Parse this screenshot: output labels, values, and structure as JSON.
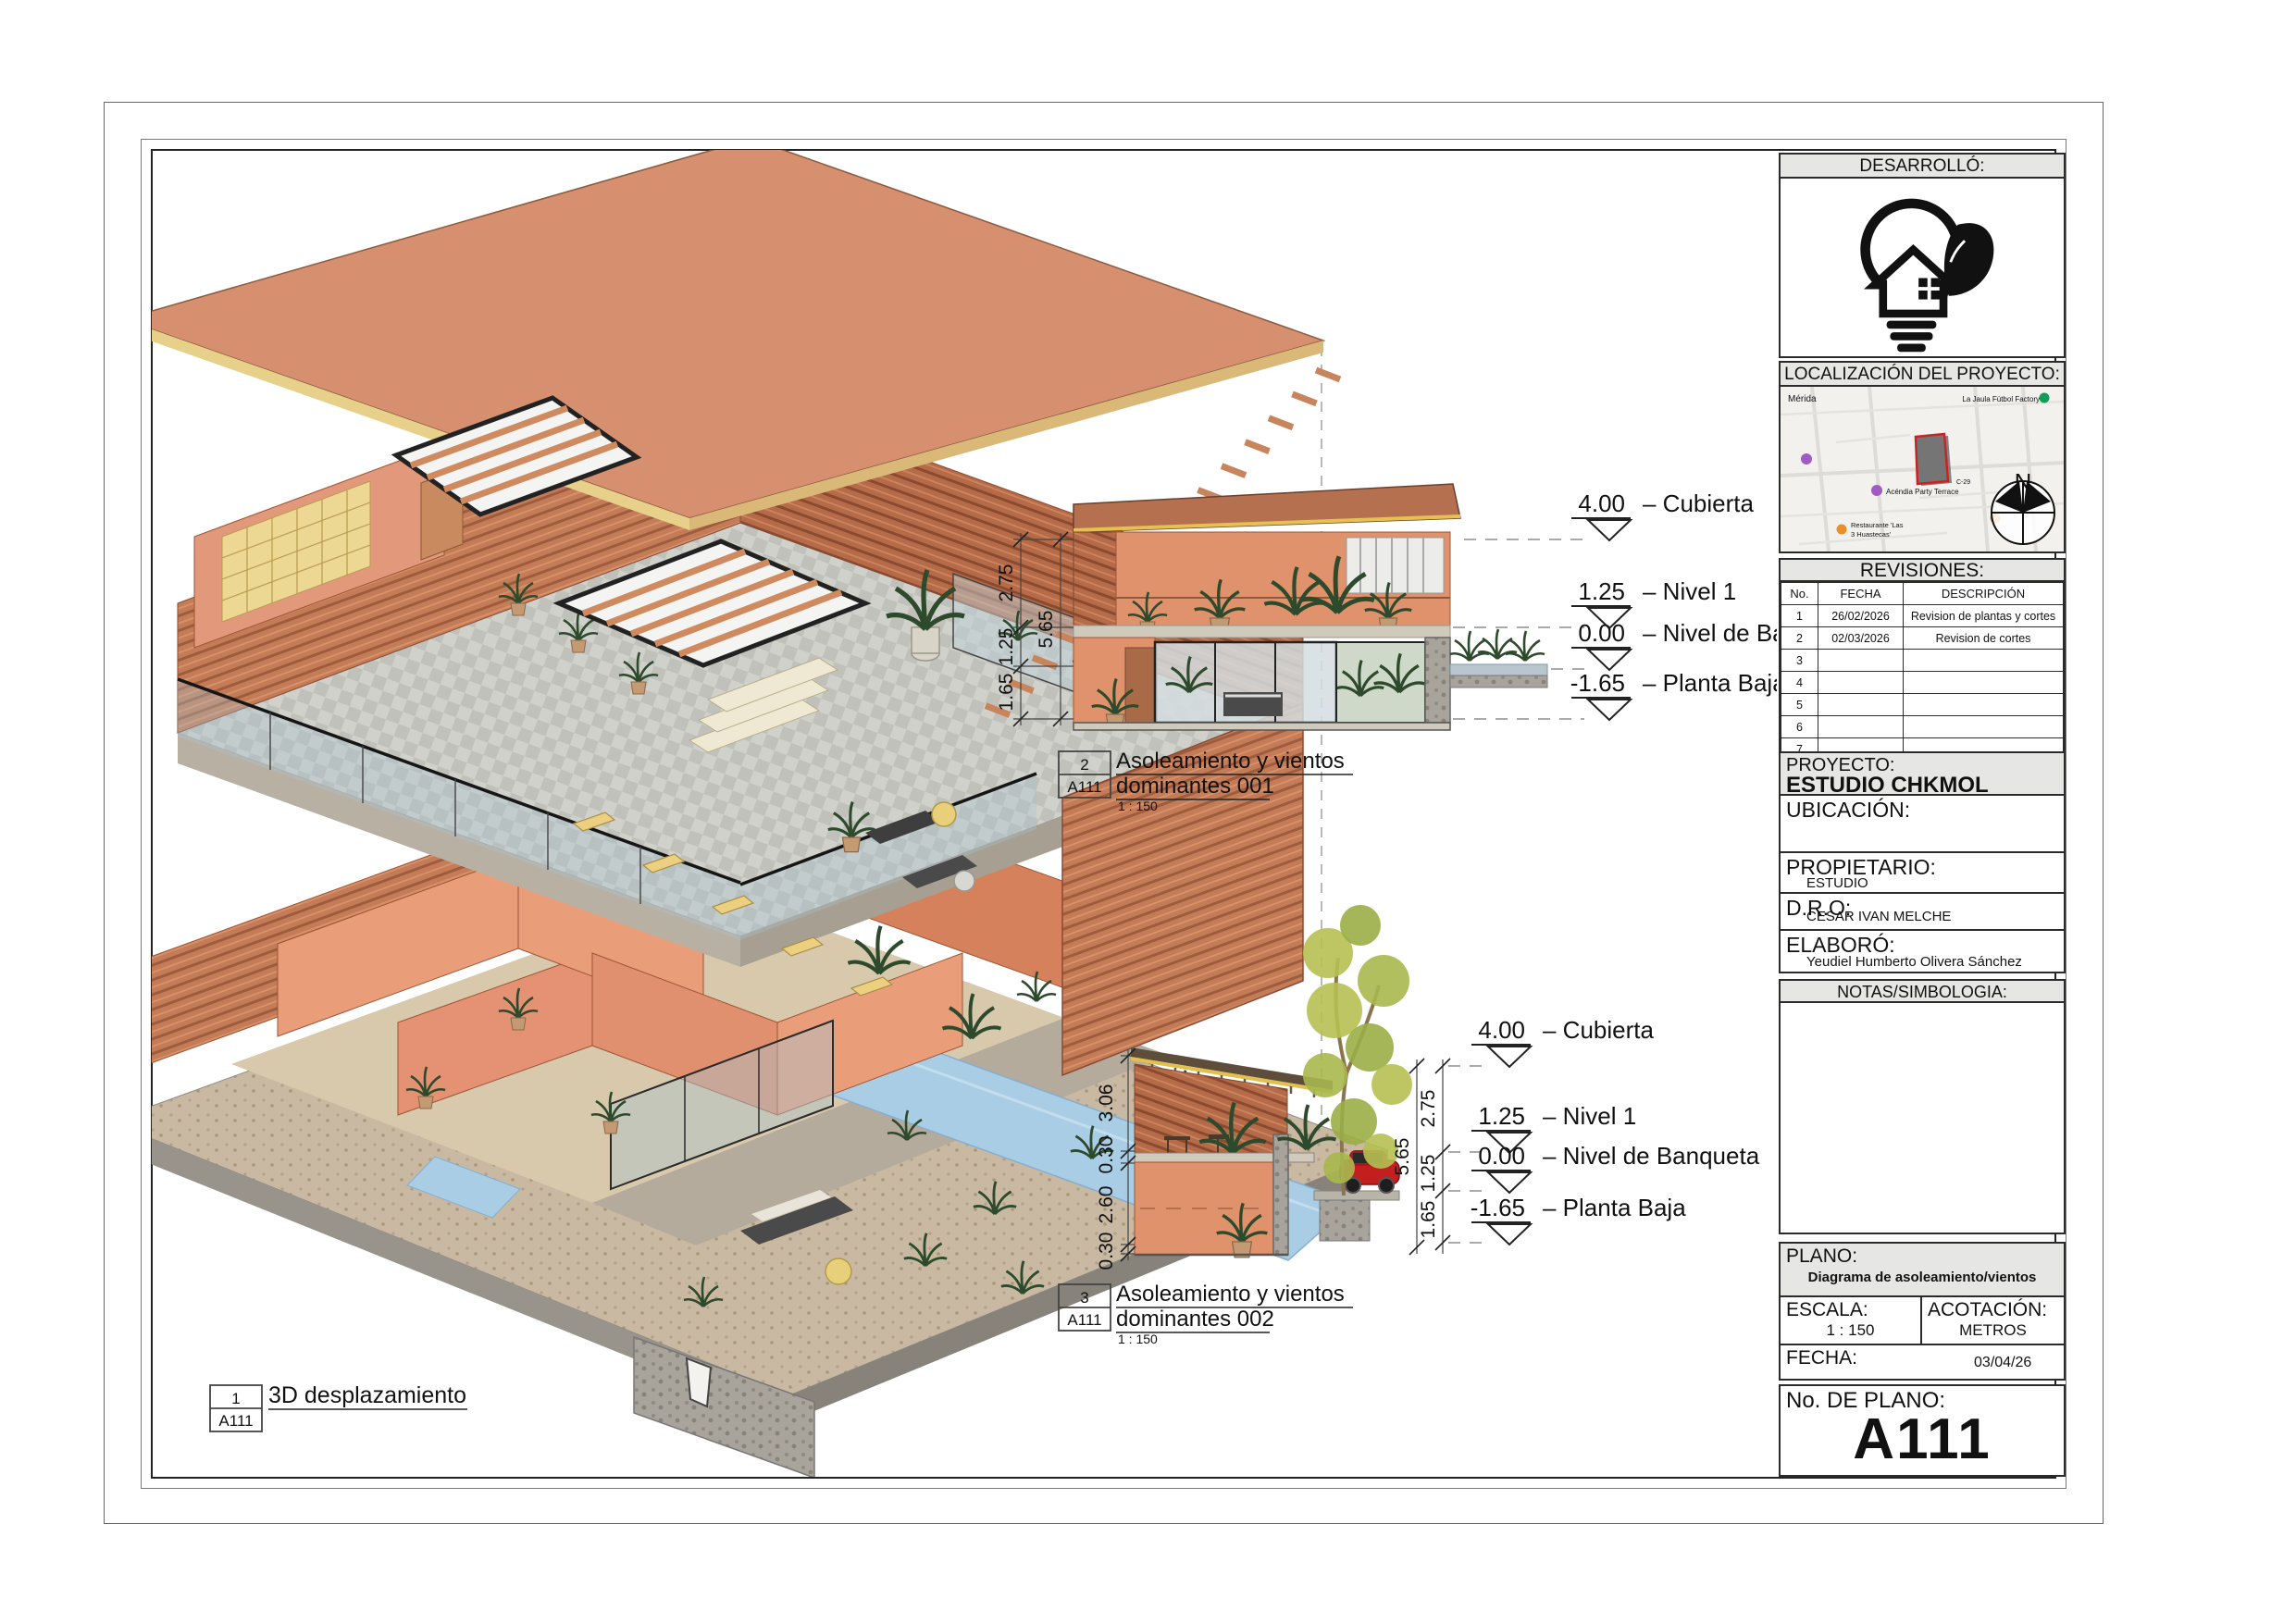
{
  "titleblock": {
    "desarrollo_label": "DESARROLLÓ:",
    "localizacion_label": "LOCALIZACIÓN DEL PROYECTO:",
    "revisiones": {
      "label": "REVISIONES:",
      "headers": [
        "No.",
        "FECHA",
        "DESCRIPCIÓN"
      ],
      "rows": [
        [
          "1",
          "26/02/2026",
          "Revision de plantas y cortes"
        ],
        [
          "2",
          "02/03/2026",
          "Revision de cortes"
        ],
        [
          "3",
          "",
          ""
        ],
        [
          "4",
          "",
          ""
        ],
        [
          "5",
          "",
          ""
        ],
        [
          "6",
          "",
          ""
        ],
        [
          "7",
          "",
          ""
        ]
      ]
    },
    "proyecto_label": "PROYECTO:",
    "proyecto_value": "ESTUDIO CHKMOL",
    "ubicacion_label": "UBICACIÓN:",
    "propietario_label": "PROPIETARIO:",
    "propietario_value": "ESTUDIO",
    "dro_label": "D.R.O:",
    "dro_value": "CESAR IVAN MELCHE",
    "elaboro_label": "ELABORÓ:",
    "elaboro_value": "Yeudiel Humberto Olivera Sánchez",
    "notas_label": "NOTAS/SIMBOLOGIA:",
    "plano_label": "PLANO:",
    "plano_value": "Diagrama de asoleamiento/vientos",
    "escala_label": "ESCALA:",
    "escala_value": "1 : 150",
    "acotacion_label": "ACOTACIÓN:",
    "acotacion_value": "METROS",
    "fecha_label": "FECHA:",
    "fecha_value": "03/04/26",
    "num_plano_label": "No. DE PLANO:",
    "num_plano_value": "A111"
  },
  "map": {
    "city": "Mérida",
    "poi1": "La Jaula Fútbol Factory",
    "poi2": "Acéndia Party Terrace",
    "poi3": "Restaurante 'Las",
    "poi3b": "3 Huastecas'",
    "street": "C-29",
    "north": "N"
  },
  "callouts": {
    "c1": {
      "number": "1",
      "sheet": "A111",
      "title": "3D desplazamiento"
    },
    "c2": {
      "number": "2",
      "sheet": "A111",
      "line1": "Asoleamiento y vientos",
      "line2": "dominantes 001",
      "scale": "1 : 150"
    },
    "c3": {
      "number": "3",
      "sheet": "A111",
      "line1": "Asoleamiento y vientos",
      "line2": "dominantes 002",
      "scale": "1 : 150"
    }
  },
  "levels": [
    {
      "value": "4.00",
      "label": "– Cubierta"
    },
    {
      "value": "1.25",
      "label": "– Nivel 1"
    },
    {
      "value": "0.00",
      "label": "– Nivel de Banqueta"
    },
    {
      "value": "-1.65",
      "label": "– Planta Baja"
    }
  ],
  "dims": {
    "s1_chain": [
      "2.75",
      "1.25",
      "1.65"
    ],
    "s1_total": "5.65",
    "s2_left": [
      "3.06",
      "0.30",
      "2.60",
      "0.30"
    ],
    "s2_chain": [
      "2.75",
      "1.25",
      "1.65"
    ],
    "s2_total": "5.65"
  },
  "colors": {
    "roof": "#d69070",
    "wall": "#e0926c",
    "wood": "#b5714f",
    "pool": "#a9cde5",
    "tile": "#cfcfc9",
    "accent_yellow": "#ecd080",
    "site_outline": "#cc2222",
    "header_gray": "#e6e6e4"
  }
}
